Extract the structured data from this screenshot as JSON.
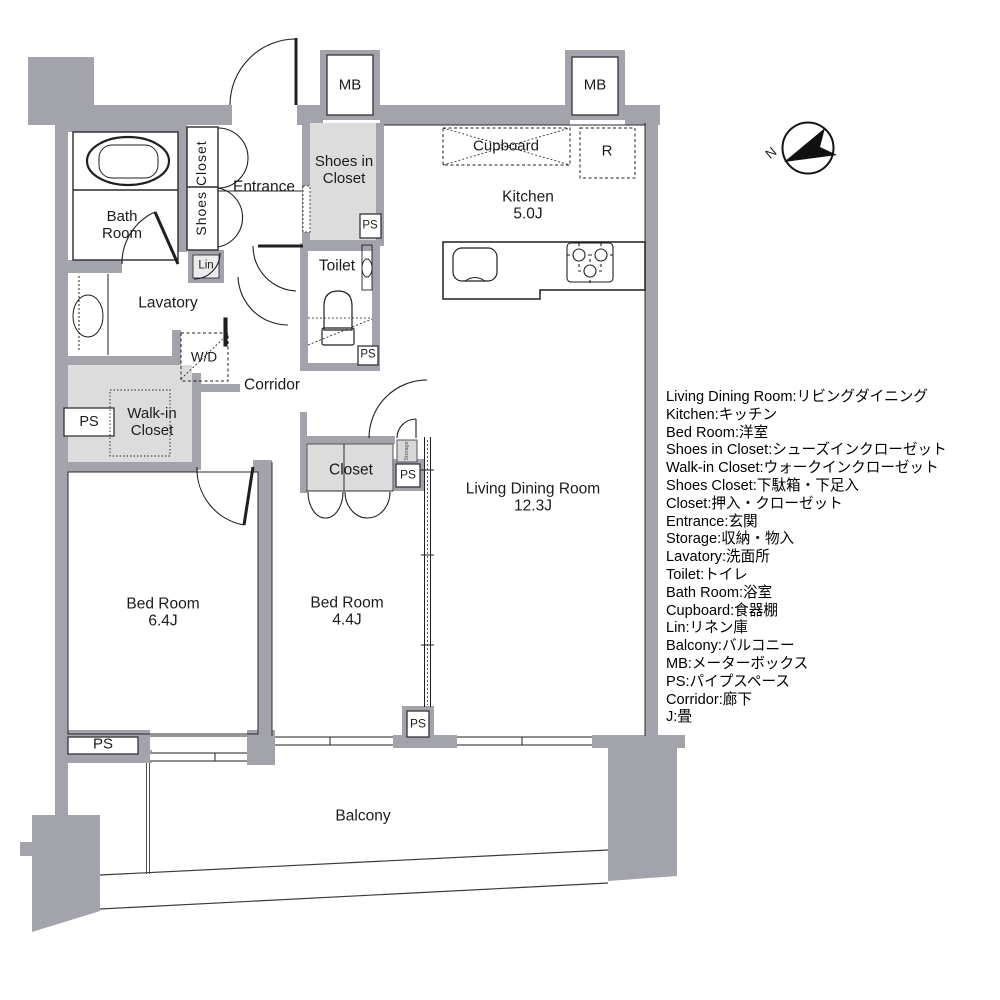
{
  "plan": {
    "compass_label": "N",
    "rooms": {
      "bath": {
        "label": "Bath Room"
      },
      "shoes_closet": {
        "label": "Shoes Closet"
      },
      "entrance": {
        "label": "Entrance"
      },
      "shoes_in_closet": {
        "label": "Shoes in Closet"
      },
      "kitchen": {
        "label": "Kitchen",
        "area": "5.0J"
      },
      "toilet": {
        "label": "Toilet"
      },
      "lavatory": {
        "label": "Lavatory"
      },
      "corridor": {
        "label": "Corridor"
      },
      "walk_in_closet": {
        "label": "Walk-in Closet"
      },
      "closet": {
        "label": "Closet"
      },
      "living_dining": {
        "label": "Living Dining Room",
        "area": "12.3J"
      },
      "bed1": {
        "label": "Bed Room",
        "area": "6.4J"
      },
      "bed2": {
        "label": "Bed Room",
        "area": "4.4J"
      },
      "balcony": {
        "label": "Balcony"
      }
    },
    "fixtures": {
      "cupboard": "Cupboard",
      "refrigerator": "R",
      "washer_dryer": "W/D",
      "linen": "Lin",
      "storage": "Storage",
      "meter_box": "MB",
      "pipe_space": "PS"
    }
  },
  "legend": {
    "items": [
      "Living Dining Room:リビングダイニング",
      "Kitchen:キッチン",
      "Bed Room:洋室",
      "Shoes in Closet:シューズインクローゼット",
      "Walk-in Closet:ウォークインクローゼット",
      "Shoes Closet:下駄箱・下足入",
      "Closet:押入・クローゼット",
      "Entrance:玄関",
      "Storage:収納・物入",
      "Lavatory:洗面所",
      "Toilet:トイレ",
      "Bath Room:浴室",
      "Cupboard:食器棚",
      "Lin:リネン庫",
      "Balcony:バルコニー",
      "MB:メーターボックス",
      "PS:パイプスペース",
      "Corridor:廊下",
      "J:畳"
    ]
  },
  "colors": {
    "wall": "#a3a3ab",
    "shade": "#dcdcdc",
    "line": "#1f1f1f"
  }
}
